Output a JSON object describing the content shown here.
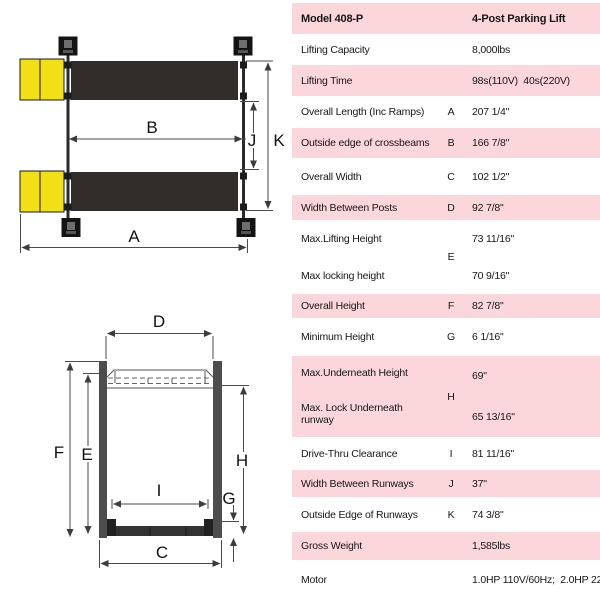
{
  "table": {
    "rows": [
      {
        "label": "Model 408-P",
        "letter": "",
        "value": "4-Post Parking Lift"
      },
      {
        "label": "Lifting Capacity",
        "letter": "",
        "value": "8,000lbs"
      },
      {
        "label": "Lifting Time",
        "letter": "",
        "value": "98s(110V)  40s(220V)"
      },
      {
        "label": "Overall Length (Inc Ramps)",
        "letter": "A",
        "value": "207 1/4\""
      },
      {
        "label": "Outside edge of crossbeams",
        "letter": "B",
        "value": "166 7/8\""
      },
      {
        "label": "Overall Width",
        "letter": "C",
        "value": "102 1/2\""
      },
      {
        "label": "Width Between Posts",
        "letter": "D",
        "value": "92 7/8\""
      },
      {
        "letter": "E",
        "items": [
          {
            "label": "Max.Lifting Height",
            "value": "73 11/16\""
          },
          {
            "label": "Max locking height",
            "value": "70 9/16\""
          }
        ]
      },
      {
        "label": "Overall Height",
        "letter": "F",
        "value": "82 7/8\""
      },
      {
        "label": "Minimum Height",
        "letter": "G",
        "value": "6 1/16\""
      },
      {
        "letter": "H",
        "items": [
          {
            "label": "Max.Underneath Height",
            "value": "69\""
          },
          {
            "label": "Max. Lock Underneath runway",
            "value": "65 13/16\""
          }
        ]
      },
      {
        "label": "Drive-Thru Clearance",
        "letter": "I",
        "value": "81 11/16\""
      },
      {
        "label": "Width Between Runways",
        "letter": "J",
        "value": "37\""
      },
      {
        "label": "Outside Edge of Runways",
        "letter": "K",
        "value": "74 3/8\""
      },
      {
        "label": "Gross Weight",
        "letter": "",
        "value": "1,585lbs"
      },
      {
        "label": "Motor",
        "letter": "",
        "value": "1.0HP 110V/60Hz;  2.0HP 220V/60Hz"
      }
    ]
  },
  "diagrams": {
    "top_view": {
      "labels": {
        "a": "A",
        "b": "B",
        "j": "J",
        "k": "K"
      }
    },
    "front_view": {
      "labels": {
        "c": "C",
        "d": "D",
        "e": "E",
        "f": "F",
        "g": "G",
        "h": "H",
        "i": "I"
      }
    }
  },
  "colors": {
    "row_pink": "#fbd7db",
    "ramp_yellow": "#f2df17",
    "runway_black": "#332d2a",
    "post_gray": "#4d4d4d"
  }
}
